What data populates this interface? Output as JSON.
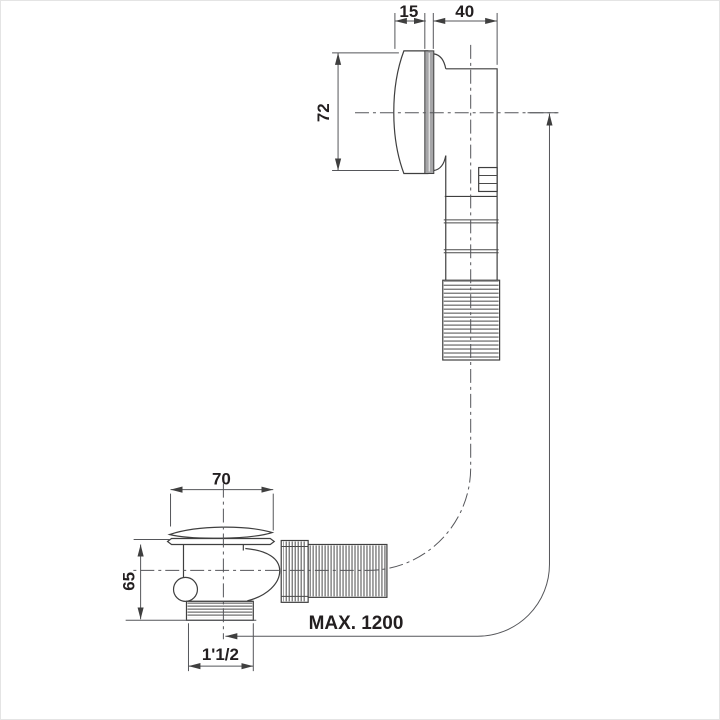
{
  "dimensions": {
    "overflow_cap_depth": "15",
    "overflow_body_depth": "40",
    "overflow_height": "72",
    "drain_cap_diameter": "70",
    "drain_body_height": "65",
    "drain_outlet_thread": "1'1/2",
    "hose_max_length": "MAX. 1200"
  },
  "colors": {
    "background": "#ffffff",
    "part_line": "#3f3f3f",
    "dimension_line": "#55565a",
    "text": "#231f20",
    "cap_ring_fill": "#a6a6a8"
  }
}
